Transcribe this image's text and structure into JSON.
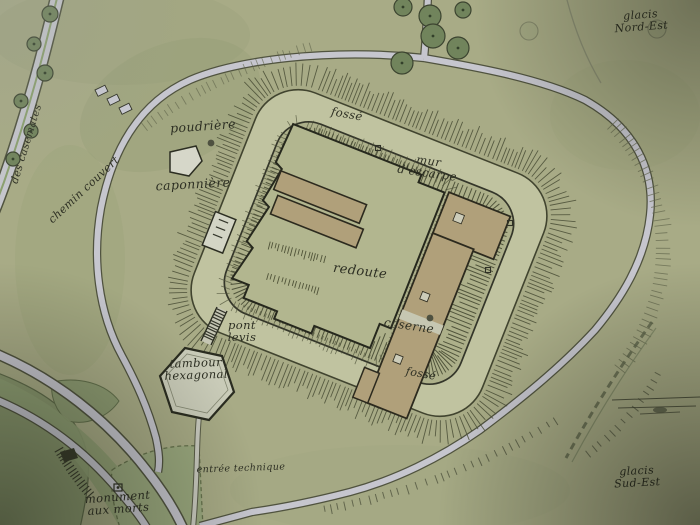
{
  "map": {
    "type": "fort-plan",
    "colors": {
      "background": "#a8ab86",
      "ditch": "#c0c3a0",
      "platform": "#adb08a",
      "redoute_fill": "#b2b68f",
      "building": "#b0a07a",
      "light_structure": "#d2d4c3",
      "road_fill": "#c6c6ce",
      "road_casing": "#53564400",
      "ink": "#2f3126",
      "hachure": "#4a4e36",
      "tree_fill": "#71845c",
      "vegetation": "#8d9b72",
      "lawn": "#9aa87e",
      "label_ink": "#2d2f23"
    },
    "labels": [
      {
        "id": "glacis-nord-est",
        "text": "glacis\nNord-Est",
        "x": 641,
        "y": 21,
        "rot": -4,
        "size": 11
      },
      {
        "id": "rue-des-casemates",
        "text": "des casemates",
        "x": 27,
        "y": 144,
        "rot": -73,
        "size": 10.5
      },
      {
        "id": "poudriere",
        "text": "poudrière",
        "x": 203,
        "y": 126,
        "rot": -4,
        "size": 12.5
      },
      {
        "id": "caponniere",
        "text": "caponnière",
        "x": 193,
        "y": 184,
        "rot": -3,
        "size": 12.5
      },
      {
        "id": "chemin-couvert",
        "text": "chemin couvert",
        "x": 84,
        "y": 190,
        "rot": -43,
        "size": 11
      },
      {
        "id": "fosse-nord",
        "text": "fossé",
        "x": 347,
        "y": 114,
        "rot": 10,
        "size": 11.5
      },
      {
        "id": "mur-escarpe",
        "text": "mur\nd'escarpe",
        "x": 428,
        "y": 167,
        "rot": 8,
        "size": 11.5
      },
      {
        "id": "redoute",
        "text": "redoute",
        "x": 360,
        "y": 272,
        "rot": 7,
        "size": 13
      },
      {
        "id": "caserne",
        "text": "caserne",
        "x": 409,
        "y": 326,
        "rot": 8,
        "size": 12
      },
      {
        "id": "fosse-sud",
        "text": "fossé",
        "x": 421,
        "y": 374,
        "rot": 10,
        "size": 11
      },
      {
        "id": "pont-levis",
        "text": "pont\nlevis",
        "x": 242,
        "y": 331,
        "rot": 0,
        "size": 11.5
      },
      {
        "id": "tambour-hexagonal",
        "text": "tambour\nhexagonal",
        "x": 196,
        "y": 369,
        "rot": -2,
        "size": 11.5
      },
      {
        "id": "entree-technique",
        "text": "entrée technique",
        "x": 241,
        "y": 469,
        "rot": -2,
        "size": 9.5
      },
      {
        "id": "monument-aux-morts",
        "text": "monument\naux morts",
        "x": 118,
        "y": 503,
        "rot": -4,
        "size": 11.5
      },
      {
        "id": "glacis-sud-est",
        "text": "glacis\nSud-Est",
        "x": 637,
        "y": 477,
        "rot": -3,
        "size": 11
      }
    ],
    "trees": [
      {
        "x": 50,
        "y": 14,
        "r": 8
      },
      {
        "x": 34,
        "y": 44,
        "r": 7
      },
      {
        "x": 45,
        "y": 73,
        "r": 8
      },
      {
        "x": 21,
        "y": 101,
        "r": 7
      },
      {
        "x": 31,
        "y": 131,
        "r": 7
      },
      {
        "x": 13,
        "y": 159,
        "r": 7
      },
      {
        "x": 403,
        "y": 7,
        "r": 9
      },
      {
        "x": 430,
        "y": 16,
        "r": 11
      },
      {
        "x": 463,
        "y": 10,
        "r": 8
      },
      {
        "x": 433,
        "y": 36,
        "r": 12
      },
      {
        "x": 458,
        "y": 48,
        "r": 11
      },
      {
        "x": 402,
        "y": 63,
        "r": 11
      }
    ],
    "faint_trees": [
      {
        "x": 529,
        "y": 31,
        "r": 9
      },
      {
        "x": 657,
        "y": 29,
        "r": 9
      }
    ],
    "markers": [
      {
        "name": "square-marker",
        "shape": "square",
        "x": 378,
        "y": 148
      },
      {
        "name": "square-marker",
        "shape": "square",
        "x": 510,
        "y": 223
      },
      {
        "name": "square-marker",
        "shape": "square",
        "x": 488,
        "y": 270
      },
      {
        "name": "dot-marker",
        "shape": "dot",
        "x": 430,
        "y": 318
      },
      {
        "name": "powder-magazine-dot",
        "shape": "dot",
        "x": 211,
        "y": 143
      },
      {
        "name": "monument-marker",
        "shape": "monument",
        "x": 114,
        "y": 484
      }
    ],
    "huts": [
      {
        "x": 95,
        "y": 90
      },
      {
        "x": 107,
        "y": 99
      },
      {
        "x": 119,
        "y": 108
      }
    ]
  }
}
